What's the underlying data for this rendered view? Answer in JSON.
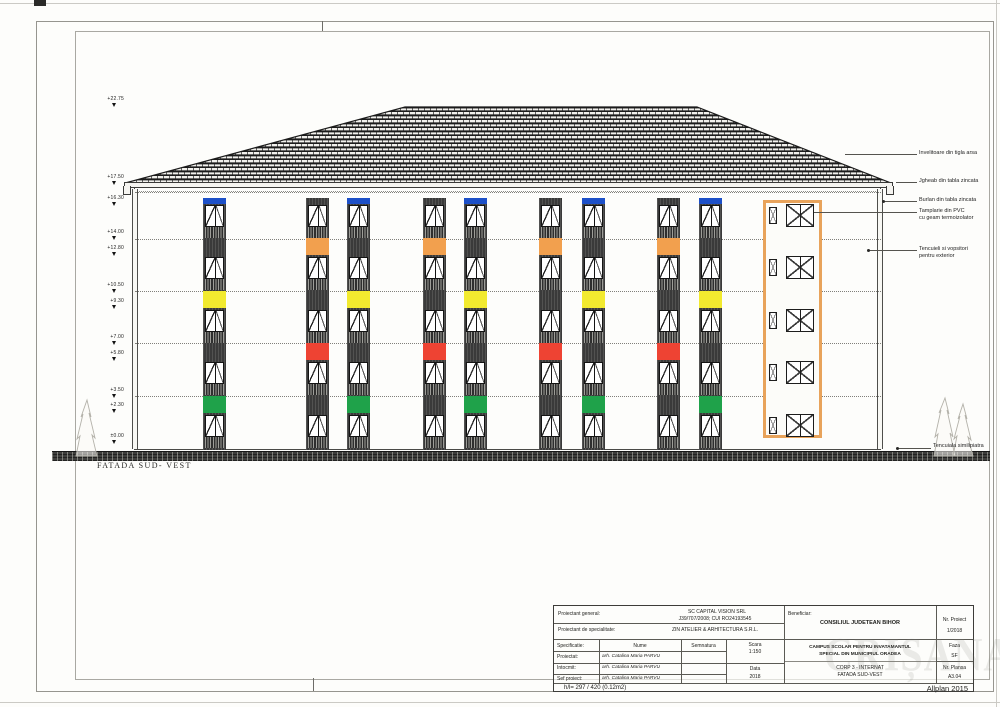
{
  "drawing": {
    "facade_label": "FATADA SUD- VEST",
    "scale_text": "1:150",
    "levels": [
      {
        "label": "+22.75",
        "y": 97
      },
      {
        "label": "+17.50",
        "y": 175
      },
      {
        "label": "+16.30",
        "y": 196
      },
      {
        "label": "+14.00",
        "y": 230
      },
      {
        "label": "+12.80",
        "y": 246
      },
      {
        "label": "+10.50",
        "y": 283
      },
      {
        "label": "+9.30",
        "y": 299
      },
      {
        "label": "+7.00",
        "y": 335
      },
      {
        "label": "+5.80",
        "y": 351
      },
      {
        "label": "+3.50",
        "y": 388
      },
      {
        "label": "+2.30",
        "y": 403
      },
      {
        "label": "±0.00",
        "y": 434
      }
    ],
    "floor_lines_y": [
      192,
      239,
      291,
      343,
      396
    ],
    "annotations": [
      {
        "lines": [
          "Invelitoare din tigla arsa"
        ],
        "top": 150,
        "leader_from": 845,
        "dot": false
      },
      {
        "lines": [
          "Jgheab din tabla zincata"
        ],
        "top": 178,
        "leader_from": 896,
        "dot": false
      },
      {
        "lines": [
          "Burlan din tabla zincata"
        ],
        "top": 197,
        "leader_from": 883,
        "dot": true
      },
      {
        "lines": [
          "Tamplarie din PVC",
          "cu geam termoizolator"
        ],
        "top": 208,
        "leader_from": 814,
        "dot": false
      },
      {
        "lines": [
          "Tencuieli si vopsitori",
          "pentru exterior"
        ],
        "top": 246,
        "leader_from": 868,
        "dot": true
      }
    ],
    "base_annotation": {
      "text": "Tencuiala similipiatra",
      "x": 933,
      "top": 443,
      "leader_from": 897,
      "leader_y": 448
    },
    "colors": {
      "blue": "#1d50c8",
      "orange": "#f2a04e",
      "yellow": "#f2ea2f",
      "red": "#ee4333",
      "green": "#1fa24a",
      "box_outline": "#e8a35b"
    },
    "strip_patterns": {
      "A": [
        "blue",
        null,
        "yellow",
        null,
        "green"
      ],
      "B": [
        null,
        "orange",
        null,
        "red",
        null
      ]
    },
    "strips": [
      {
        "x": 203,
        "pattern": "A"
      },
      {
        "x": 306,
        "pattern": "B"
      },
      {
        "x": 347,
        "pattern": "A"
      },
      {
        "x": 423,
        "pattern": "B"
      },
      {
        "x": 464,
        "pattern": "A"
      },
      {
        "x": 539,
        "pattern": "B"
      },
      {
        "x": 582,
        "pattern": "A"
      },
      {
        "x": 657,
        "pattern": "B"
      },
      {
        "x": 699,
        "pattern": "A"
      }
    ],
    "strip_geom": {
      "width": 23,
      "top": 198,
      "height": 252,
      "win_h": 22,
      "hatch_h": 11,
      "floors": [
        {
          "band": 0,
          "band_h": 6,
          "win": 7
        },
        {
          "band": 40,
          "band_h": 17,
          "win": 59
        },
        {
          "band": 93,
          "band_h": 17,
          "win": 112
        },
        {
          "band": 145,
          "band_h": 17,
          "win": 164
        },
        {
          "band": 198,
          "band_h": 17,
          "win": 217
        }
      ]
    },
    "highlight_box": {
      "x": 763,
      "y": 200,
      "w": 59,
      "h": 238,
      "floors": [
        1,
        53,
        106,
        158,
        211
      ],
      "big": {
        "dx": 20,
        "w": 28,
        "h": 23
      },
      "small": {
        "dx": 3,
        "dy": 3,
        "w": 8,
        "h": 17
      }
    }
  },
  "titleblock": {
    "proiectant_general_label": "Proiectant general:",
    "proiectant_general_1": "SC CAPITAL VISION SRL",
    "proiectant_general_2": "J39/707/2008; CUI RO24193545",
    "proiectant_spec_label": "Proiectant de specialitate:",
    "proiectant_spec_value": "ZIN ATELIER & ARHITECTURA S.R.L.",
    "beneficiar_label": "Beneficiar:",
    "beneficiar_value": "CONSILIUL JUDETEAN BIHOR",
    "nr_proiect_label": "Nr. Proiect",
    "nr_proiect_value": "1/2018",
    "specificatie_label": "Specificatie:",
    "nume_header": "Nume",
    "semnatura_header": "Semnatura",
    "scara_label": "Scara",
    "scara_value": "1:150",
    "rows": [
      {
        "label": "Proiectat:",
        "name": "arh. Catalina Maria PARVU"
      },
      {
        "label": "Intocmit:",
        "name": "arh. Catalina Maria PARVU"
      },
      {
        "label": "Sef proiect:",
        "name": "arh. Catalina Maria PARVU"
      }
    ],
    "data_label": "Data",
    "data_value": "2018",
    "project_title_1": "CAMPUS SCOLAR PENTRU INVATAMANTUL",
    "project_title_2": "SPECIAL DIN MUNICIPIUL ORADEA",
    "drawing_title_1": "CORP 3 - INTERNAT",
    "drawing_title_2": "FATADA SUD-VEST",
    "faza_label": "Faza",
    "faza_value": "SF",
    "nr_plansa_label": "Nr. Plansa",
    "nr_plansa_value": "A3.04",
    "format_info": "h/l= 297 / 420 (0.12m2)",
    "app_credit": "Allplan 2015",
    "watermark": "CRIȘANA"
  }
}
